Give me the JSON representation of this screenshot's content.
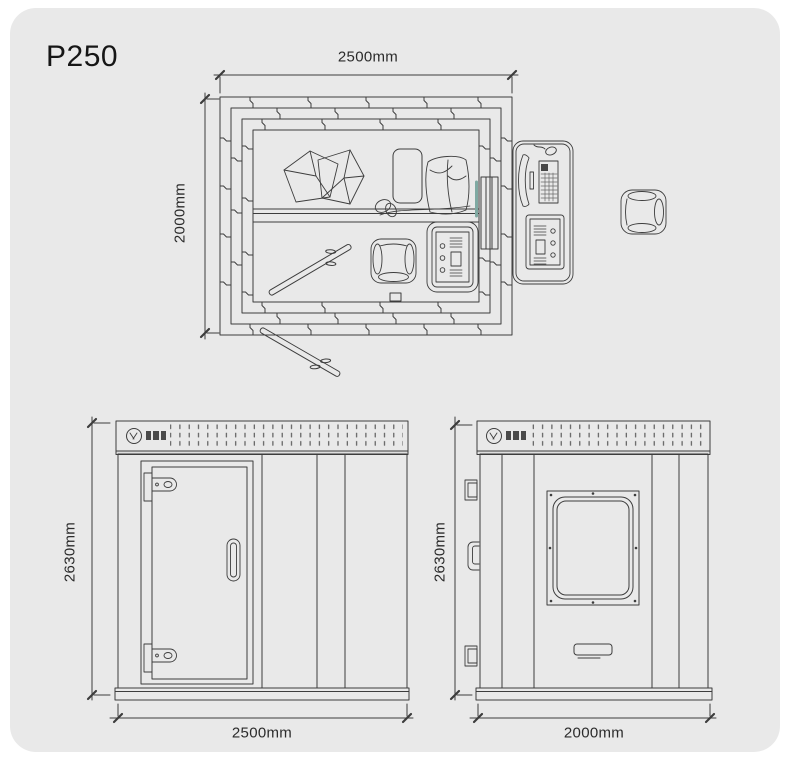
{
  "title": "P250",
  "colors": {
    "page_bg": "#ffffff",
    "panel_bg": "#e9e9e9",
    "line": "#3d3d3d",
    "window_glass": "#7fa9a2"
  },
  "dimensions": {
    "plan_width": "2500mm",
    "plan_depth": "2000mm",
    "front_height": "2630mm",
    "front_width": "2500mm",
    "side_height": "2630mm",
    "side_width": "2000mm"
  }
}
